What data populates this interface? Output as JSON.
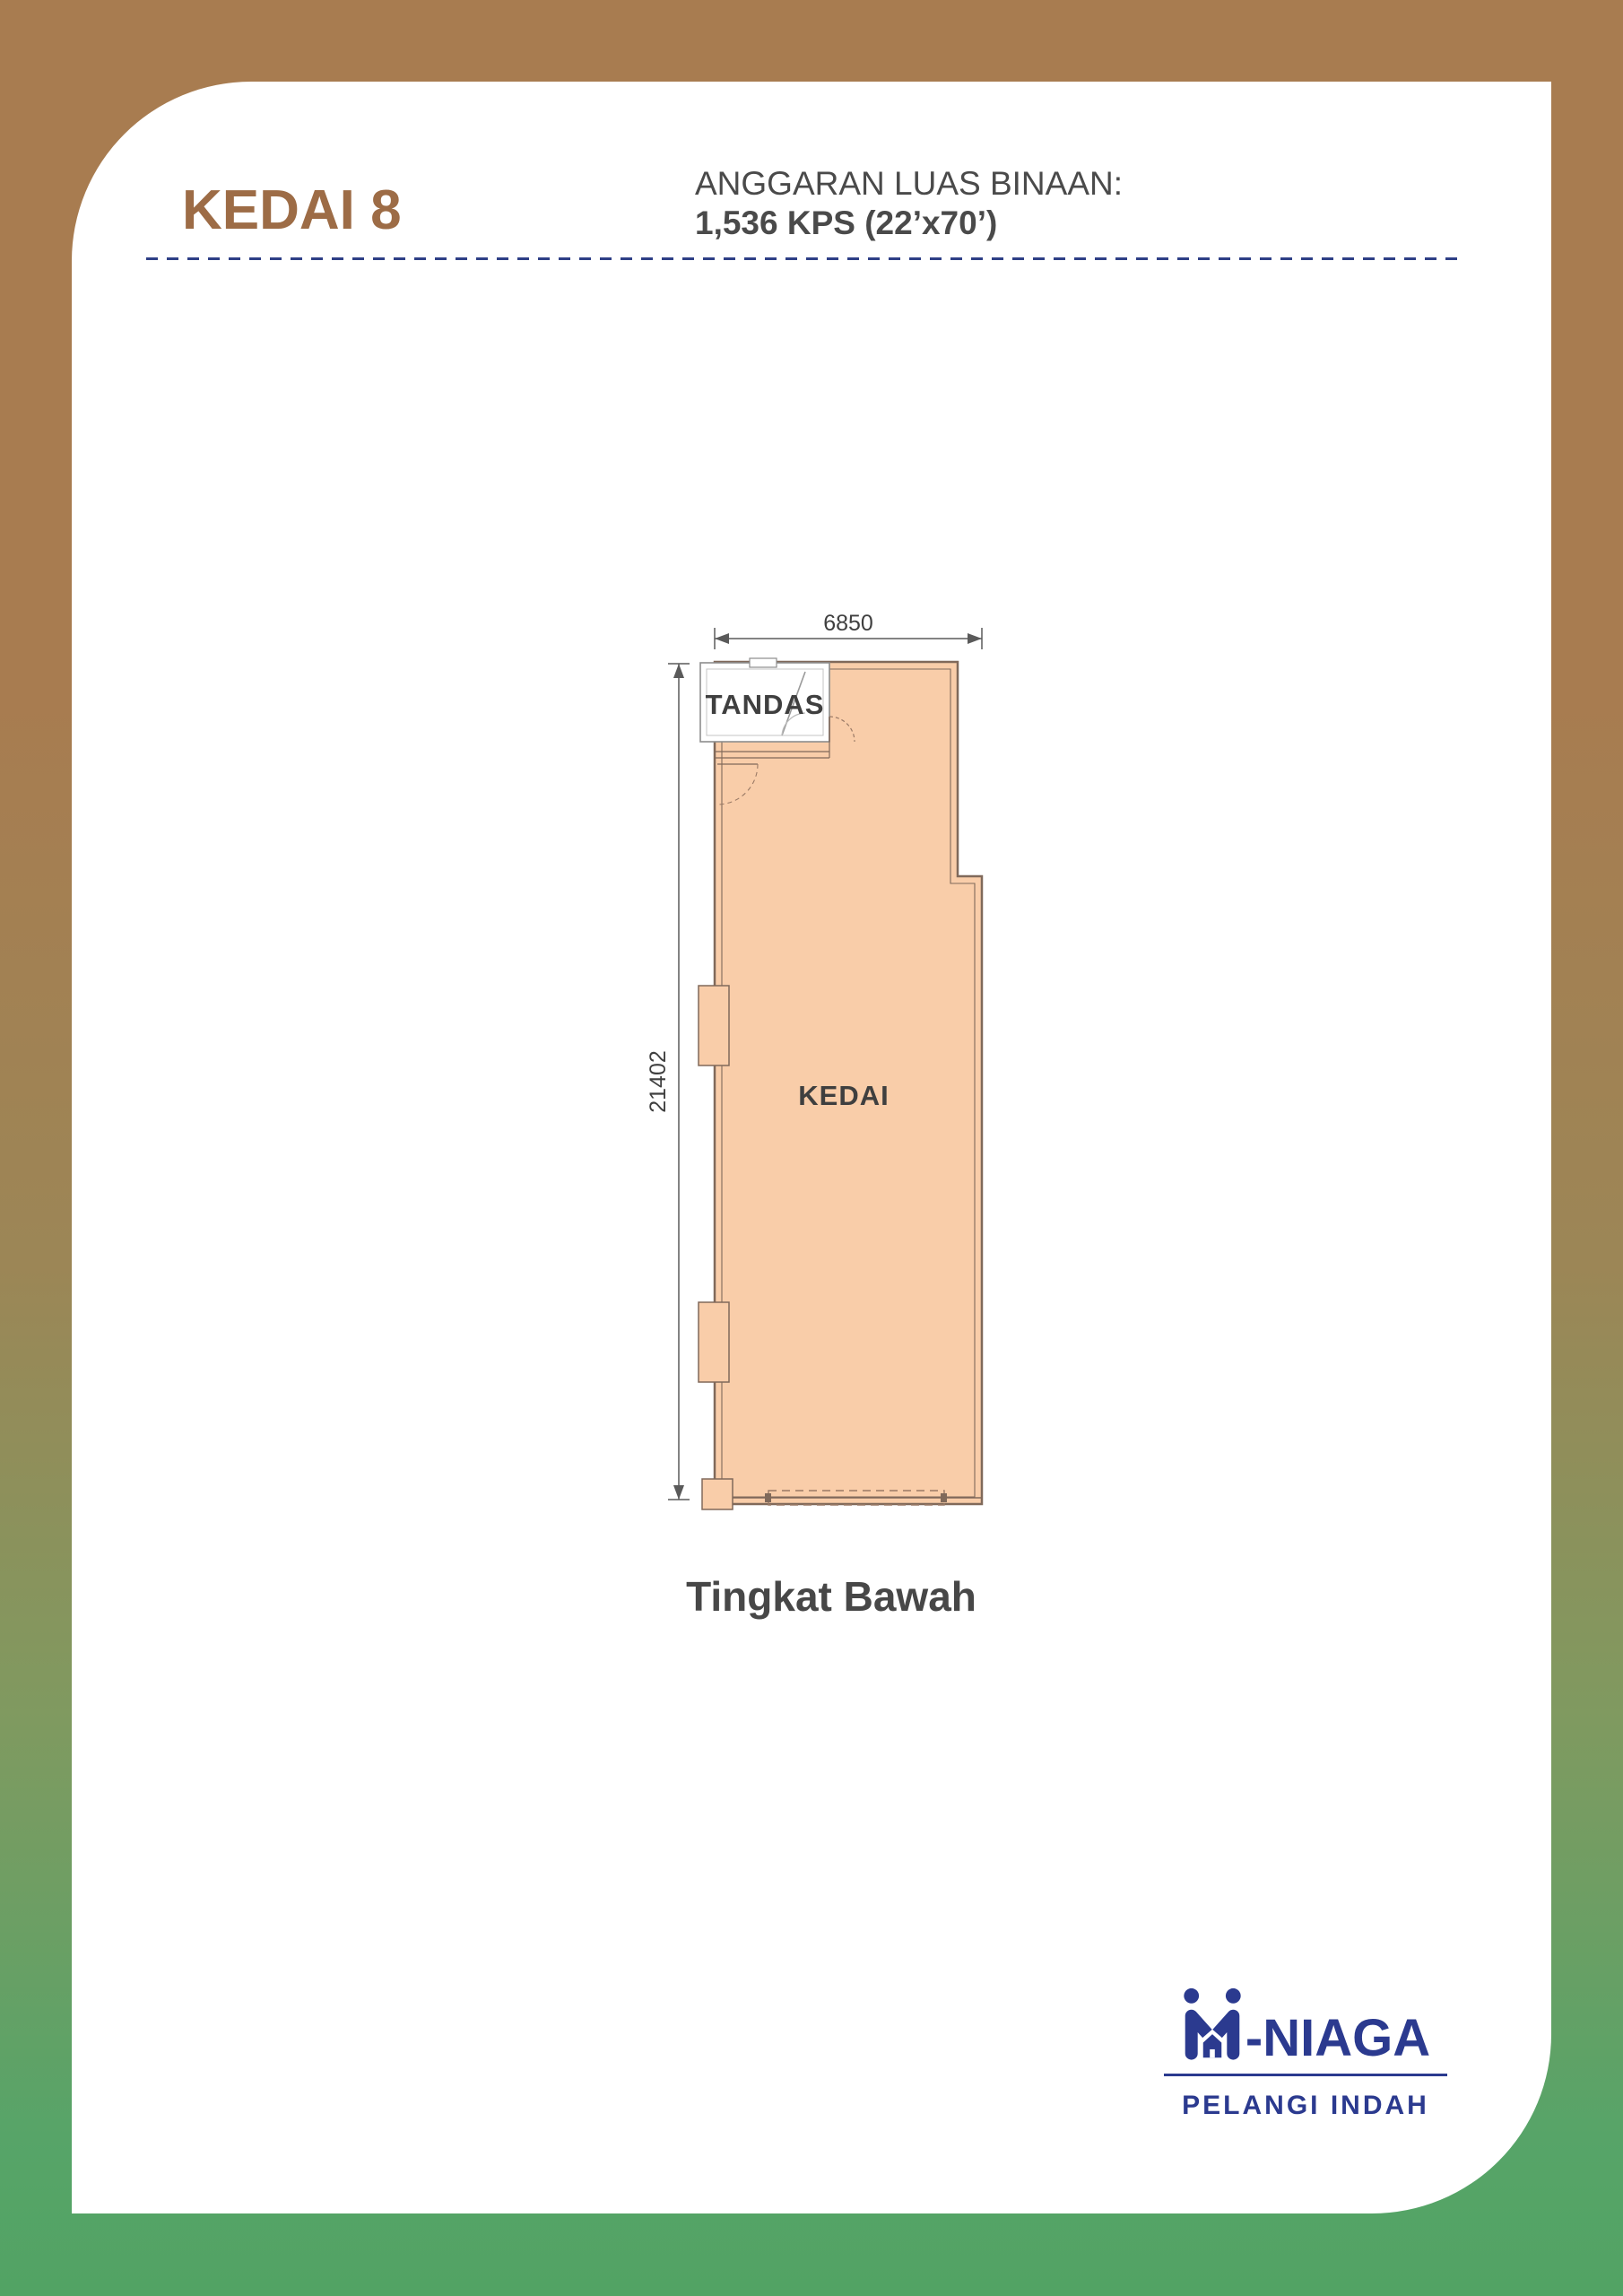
{
  "header": {
    "unit_title": "KEDAI 8",
    "area_label": "ANGGARAN LUAS BINAAN:",
    "area_value": "1,536 KPS (22’x70’)"
  },
  "plan": {
    "width_dim": "6850",
    "height_dim": "21402",
    "toilet_label": "TANDAS",
    "shop_label": "KEDAI",
    "floor_caption": "Tingkat Bawah"
  },
  "logo": {
    "mark": "m-people-house-logo",
    "brand": "-NIAGA",
    "tagline": "PELANGI INDAH"
  },
  "colors": {
    "background_top": "#a87c50",
    "background_bottom": "#57a468",
    "card": "#ffffff",
    "title_brown": "#9d6c46",
    "text_dark": "#474747",
    "divider_navy": "#2e3f86",
    "plan_fill": "#f9cda9",
    "plan_wall": "#80695a",
    "logo_navy": "#2b3a8f"
  }
}
